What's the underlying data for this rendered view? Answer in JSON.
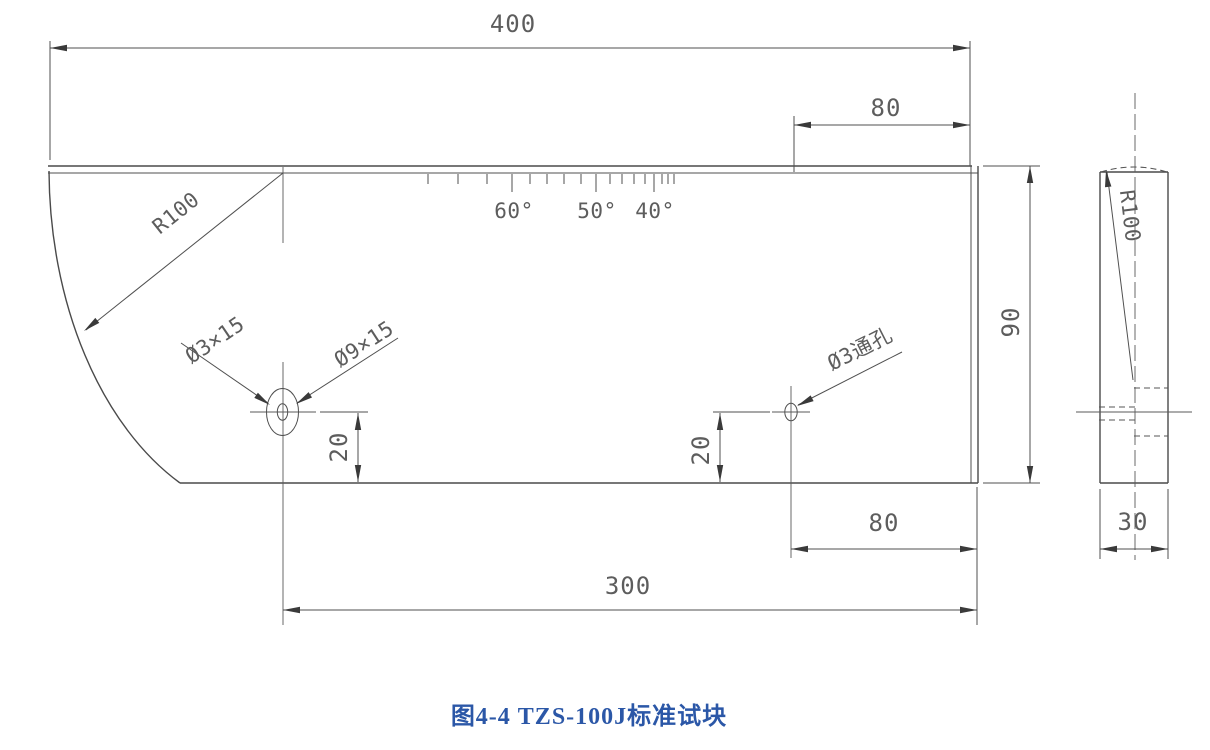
{
  "figure": {
    "caption": "图4-4  TZS-100J标准试块",
    "caption_color": "#2b57a7"
  },
  "drawing": {
    "line_color": "#4a4a4a",
    "dim_text_color": "#5d5d5d",
    "front_view": {
      "length_total": "400",
      "offset_top_right": "80",
      "height": "90",
      "hole1_to_bottom": "20",
      "hole2_to_bottom": "20",
      "hole2_to_right": "80",
      "hole1_to_right": "300",
      "arc_radius": "R100",
      "hole1_small": "Ø3×15",
      "hole1_counterbore": "Ø9×15",
      "hole2_label": "Ø3通孔",
      "angle_ticks": {
        "a60": "60°",
        "a50": "50°",
        "a40": "40°"
      }
    },
    "side_view": {
      "thickness": "30",
      "arc_radius": "R100"
    }
  }
}
